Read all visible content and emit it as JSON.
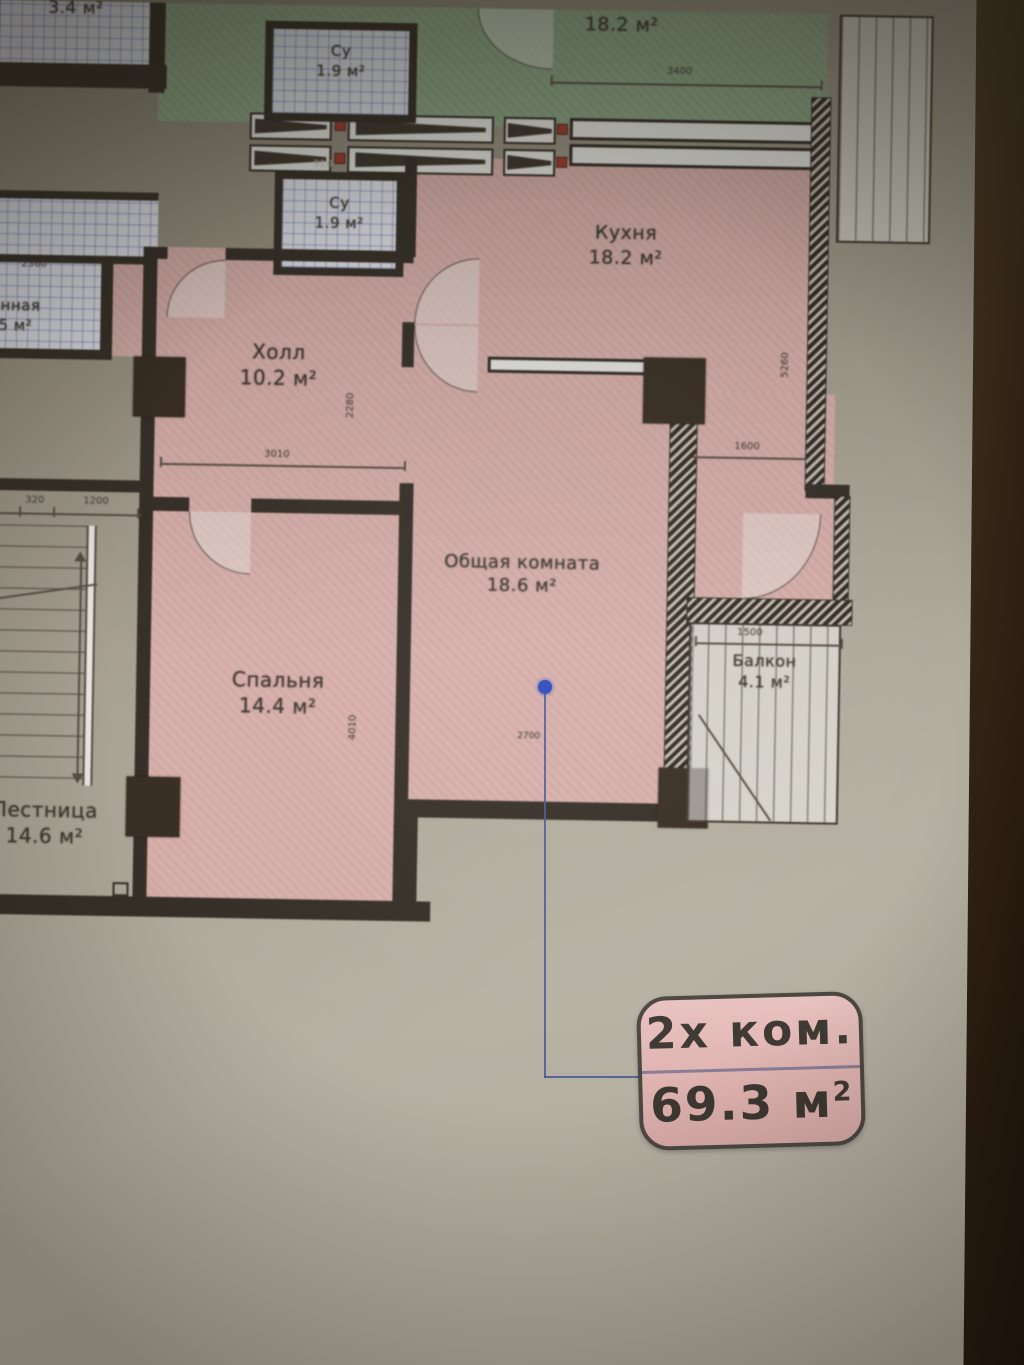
{
  "plan": {
    "rooms": {
      "tiled_small": {
        "area": "3.4 м²"
      },
      "su_top": {
        "name": "Су",
        "area": "1.9 м²"
      },
      "green_room": {
        "area": "18.2 м²"
      },
      "su_mid": {
        "name": "Су",
        "area": "1.9 м²"
      },
      "kitchen": {
        "name": "Кухня",
        "area": "18.2 м²"
      },
      "hall": {
        "name": "Холл",
        "area": "10.2 м²"
      },
      "bedroom": {
        "name": "Спальня",
        "area": "14.4 м²"
      },
      "living": {
        "name": "Общая комната",
        "area": "18.6 м²"
      },
      "balcony": {
        "name": "Балкон",
        "area": "4.1 м²"
      },
      "stairs": {
        "name": "Лестница",
        "area": "14.6 м²"
      },
      "edge_partial": {
        "name": "анная",
        "area": "5 м²"
      }
    },
    "dims": {
      "green_width": "3400",
      "su_mid_width": "910",
      "edge_width": "2360",
      "hall_width": "3010",
      "hall_depth": "2280",
      "kitchen_depth": "5260",
      "kitchen_side": "1600",
      "balcony_width": "1500",
      "living_width": "2700",
      "bedroom_depth": "4010",
      "stairs_dim1": "320",
      "stairs_dim2": "1200"
    },
    "colors": {
      "apartment_fill": "#d9b0ac",
      "other_apartment_fill": "#91a989",
      "wet_room_fill": "#e3e3ea",
      "wall": "#332c24",
      "marker_blue": "#2d49bd"
    }
  },
  "badge": {
    "line1": "2х ком.",
    "line2_value": "69.3 м",
    "line2_sup": "2"
  }
}
